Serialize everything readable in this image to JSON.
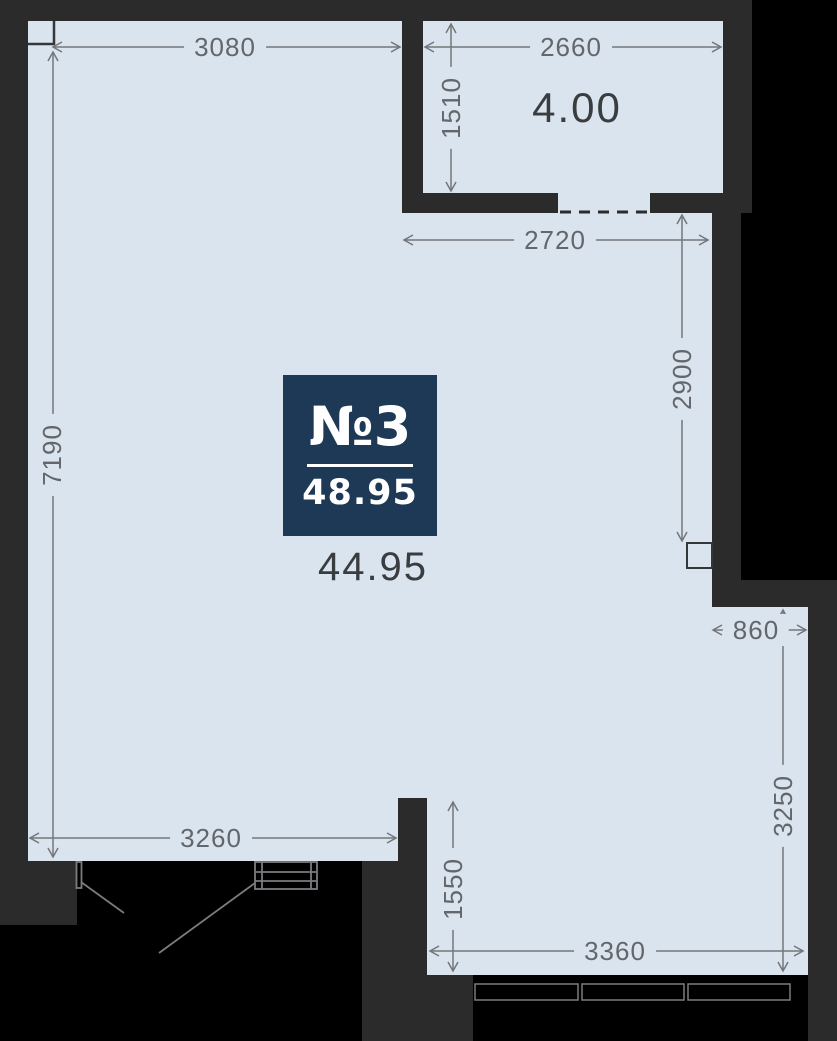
{
  "unit": {
    "number": "№3",
    "total_area": "48.95",
    "living_area": "44.95",
    "balcony_area": "4.00"
  },
  "dimensions": {
    "top_left_width": "3080",
    "left_height": "7190",
    "balcony_width": "2660",
    "balcony_depth": "1510",
    "upper_right_width": "2720",
    "right_upper_height": "2900",
    "right_notch_width": "860",
    "right_lower_height": "3250",
    "bottom_step_height": "1550",
    "bottom_width": "3360",
    "bottom_left_width": "3260"
  },
  "colors": {
    "floor": "#d9e4ee",
    "wall": "#2b2b2c",
    "outside": "#000000",
    "unit_card": "#1d3956",
    "dimension_gray": "#74767a",
    "area_text": "#3a3d40"
  }
}
